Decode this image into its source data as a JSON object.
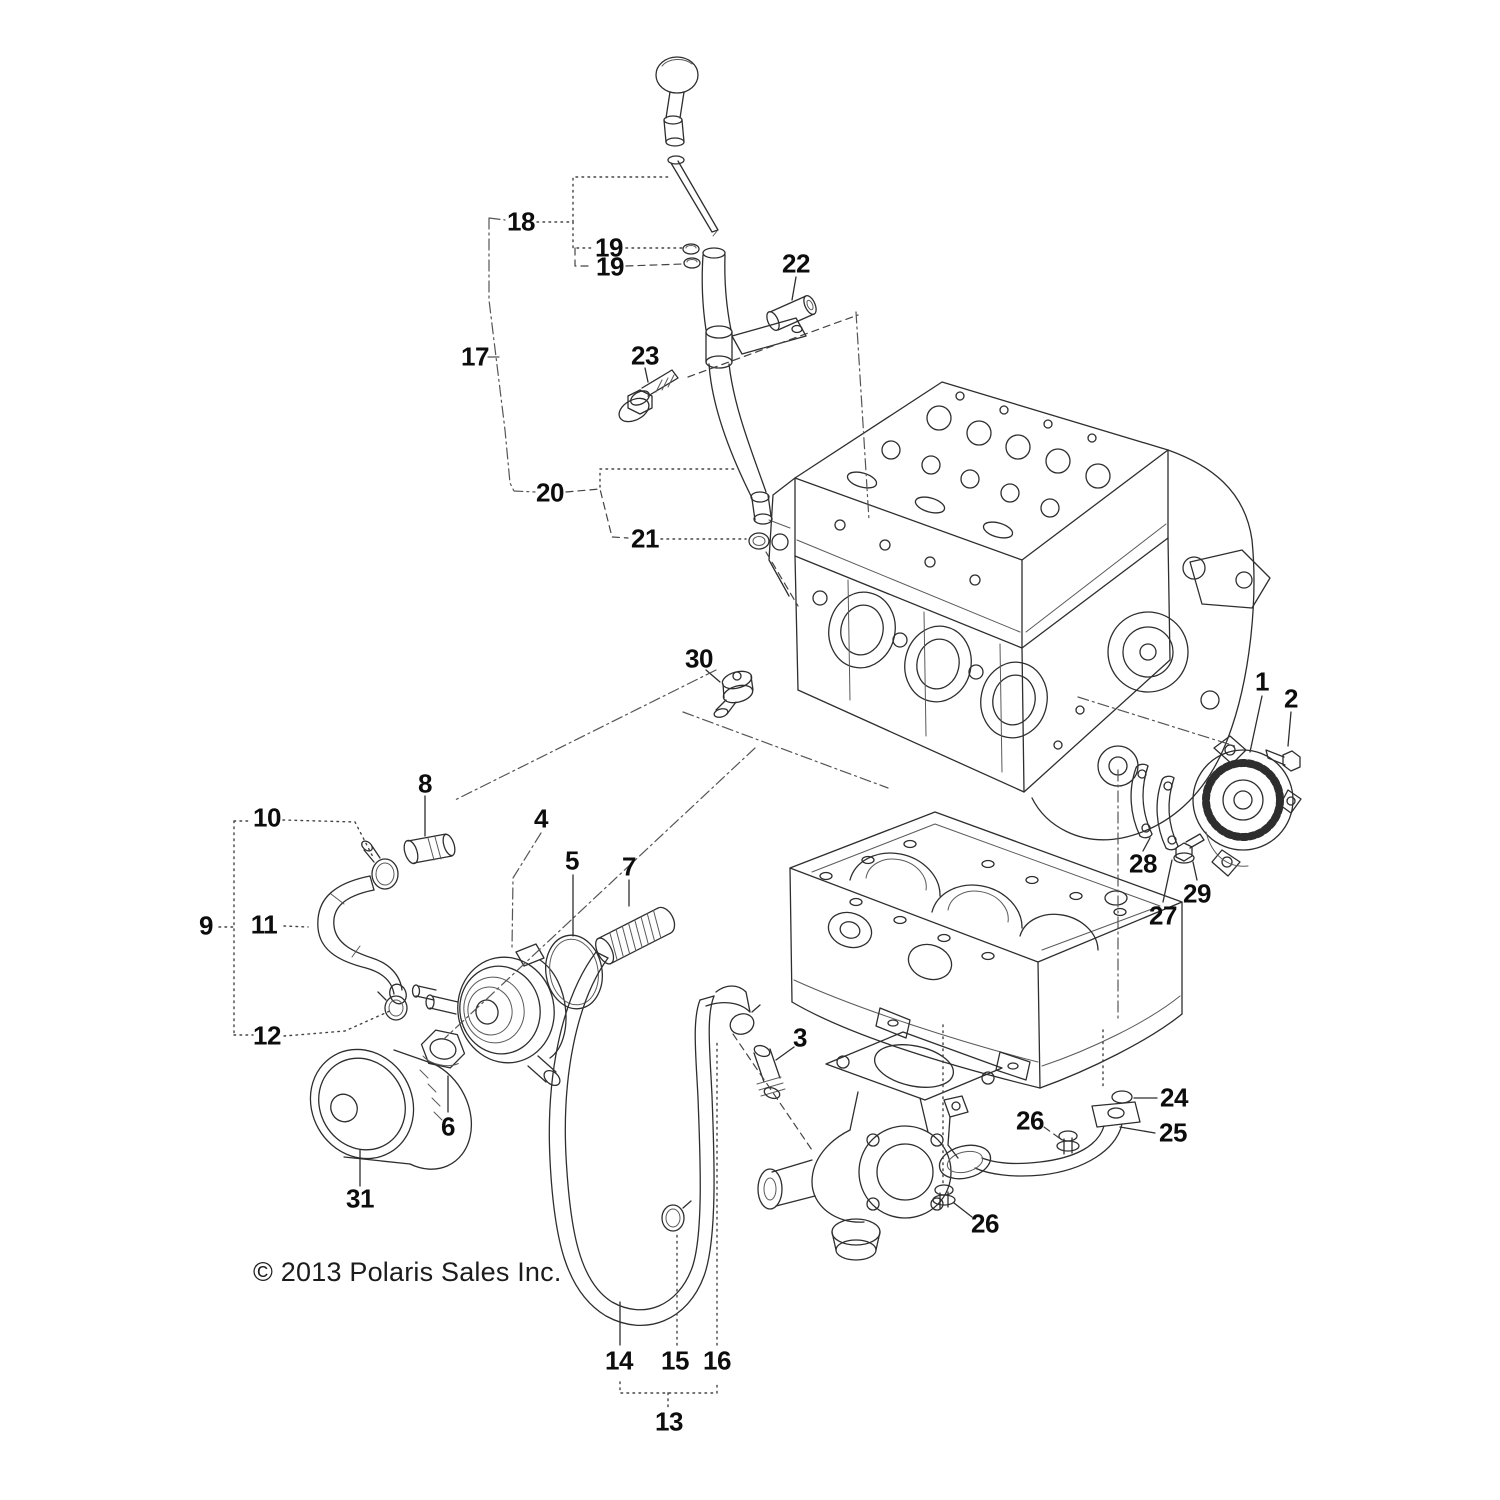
{
  "page": {
    "background": "#ffffff",
    "ink_color": "#2e2e2e",
    "text_color": "#0d0d0d"
  },
  "copyright": "© 2013 Polaris Sales Inc.",
  "callouts": [
    {
      "id": "1",
      "label": "1",
      "x": 1262,
      "y": 682
    },
    {
      "id": "2",
      "label": "2",
      "x": 1291,
      "y": 699
    },
    {
      "id": "3",
      "label": "3",
      "x": 800,
      "y": 1038
    },
    {
      "id": "4",
      "label": "4",
      "x": 541,
      "y": 819
    },
    {
      "id": "5",
      "label": "5",
      "x": 572,
      "y": 861
    },
    {
      "id": "6",
      "label": "6",
      "x": 448,
      "y": 1127
    },
    {
      "id": "7",
      "label": "7",
      "x": 629,
      "y": 867
    },
    {
      "id": "8",
      "label": "8",
      "x": 425,
      "y": 784
    },
    {
      "id": "9",
      "label": "9",
      "x": 206,
      "y": 926
    },
    {
      "id": "10",
      "label": "10",
      "x": 267,
      "y": 818
    },
    {
      "id": "11",
      "label": "11",
      "x": 264,
      "y": 925
    },
    {
      "id": "12",
      "label": "12",
      "x": 267,
      "y": 1036
    },
    {
      "id": "13",
      "label": "13",
      "x": 669,
      "y": 1422
    },
    {
      "id": "14",
      "label": "14",
      "x": 619,
      "y": 1361
    },
    {
      "id": "15",
      "label": "15",
      "x": 675,
      "y": 1361
    },
    {
      "id": "16",
      "label": "16",
      "x": 717,
      "y": 1361
    },
    {
      "id": "17",
      "label": "17",
      "x": 475,
      "y": 357
    },
    {
      "id": "18",
      "label": "18",
      "x": 521,
      "y": 222
    },
    {
      "id": "19a",
      "label": "19",
      "x": 609,
      "y": 248
    },
    {
      "id": "19b",
      "label": "19",
      "x": 610,
      "y": 267
    },
    {
      "id": "20",
      "label": "20",
      "x": 550,
      "y": 493
    },
    {
      "id": "21",
      "label": "21",
      "x": 645,
      "y": 539
    },
    {
      "id": "22",
      "label": "22",
      "x": 796,
      "y": 264
    },
    {
      "id": "23",
      "label": "23",
      "x": 645,
      "y": 356
    },
    {
      "id": "24",
      "label": "24",
      "x": 1174,
      "y": 1098
    },
    {
      "id": "25",
      "label": "25",
      "x": 1173,
      "y": 1133
    },
    {
      "id": "26a",
      "label": "26",
      "x": 1030,
      "y": 1121
    },
    {
      "id": "26b",
      "label": "26",
      "x": 985,
      "y": 1224
    },
    {
      "id": "27",
      "label": "27",
      "x": 1163,
      "y": 916
    },
    {
      "id": "28",
      "label": "28",
      "x": 1143,
      "y": 864
    },
    {
      "id": "29",
      "label": "29",
      "x": 1197,
      "y": 894
    },
    {
      "id": "30",
      "label": "30",
      "x": 699,
      "y": 659
    },
    {
      "id": "31",
      "label": "31",
      "x": 360,
      "y": 1199
    }
  ]
}
